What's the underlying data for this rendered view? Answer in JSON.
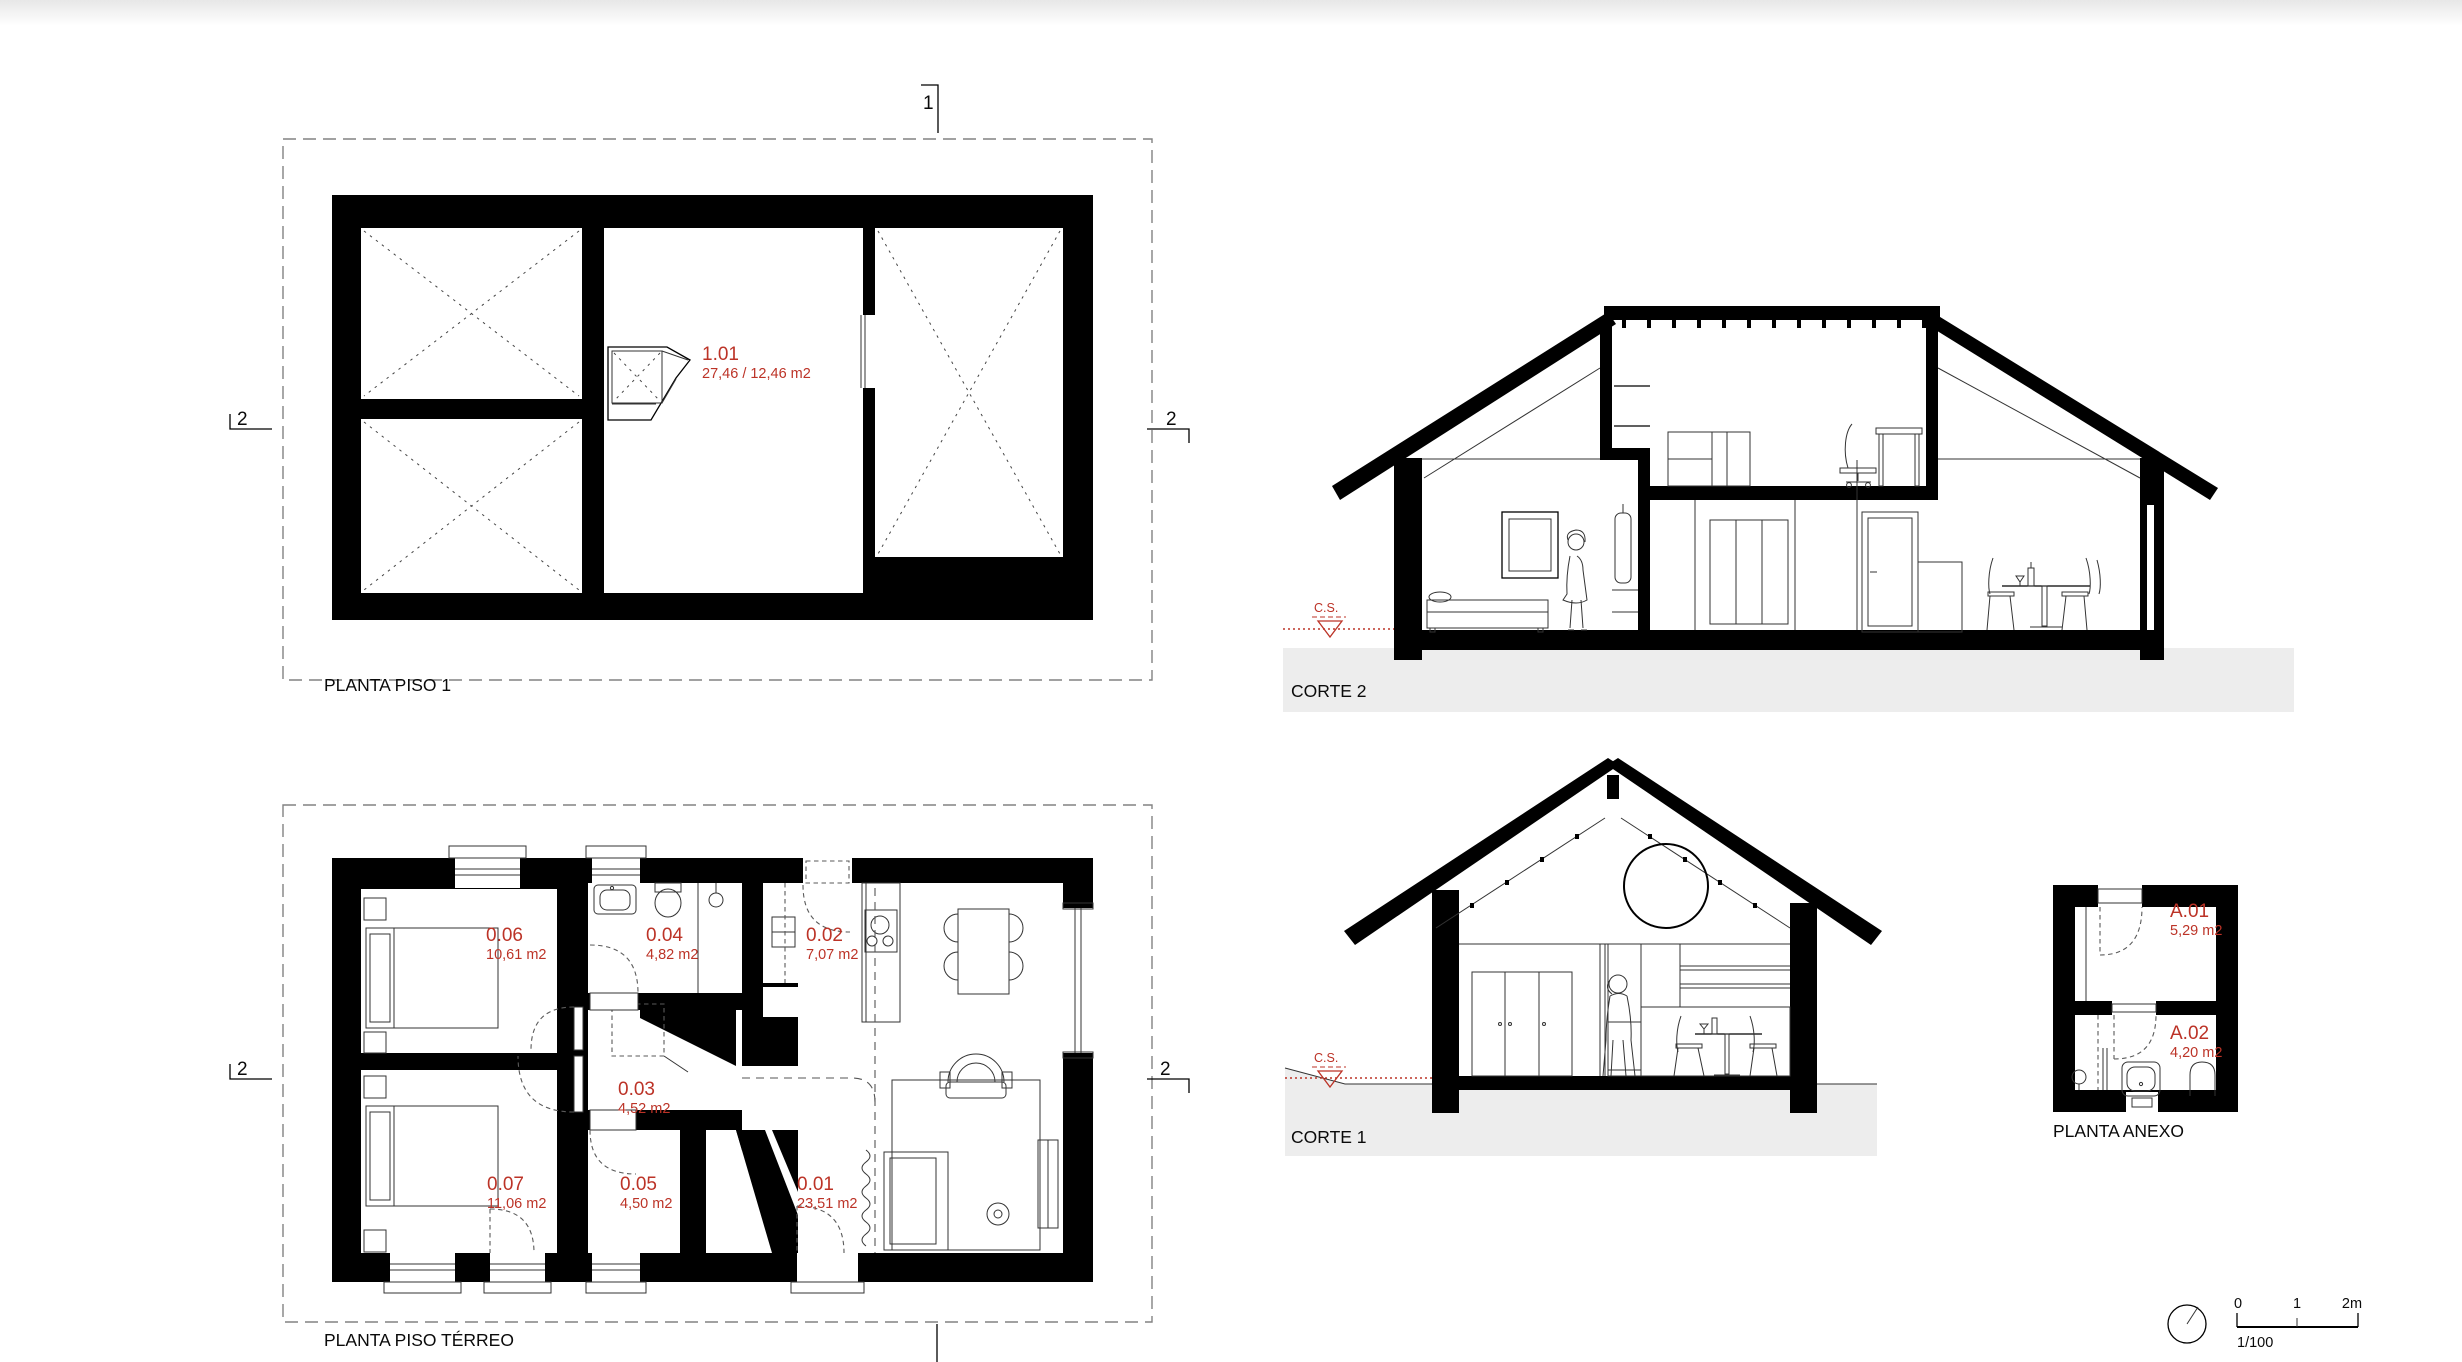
{
  "colors": {
    "accent": "#bc3327",
    "ground": "#ededed"
  },
  "drawings": {
    "planta_piso1": {
      "title": "PLANTA PISO 1",
      "rooms": [
        {
          "id": "1.01",
          "area": "27,46 / 12,46 m2"
        }
      ]
    },
    "corte2": {
      "title": "CORTE 2",
      "level_marker": "C.S."
    },
    "planta_terreo": {
      "title": "PLANTA PISO TÉRREO",
      "rooms": [
        {
          "id": "0.06",
          "area": "10,61 m2"
        },
        {
          "id": "0.04",
          "area": "4,82 m2"
        },
        {
          "id": "0.02",
          "area": "7,07 m2"
        },
        {
          "id": "0.03",
          "area": "4,52 m2"
        },
        {
          "id": "0.07",
          "area": "11,06 m2"
        },
        {
          "id": "0.05",
          "area": "4,50 m2"
        },
        {
          "id": "0.01",
          "area": "23,51 m2"
        }
      ]
    },
    "corte1": {
      "title": "CORTE 1",
      "level_marker": "C.S."
    },
    "planta_anexo": {
      "title": "PLANTA ANEXO",
      "rooms": [
        {
          "id": "A.01",
          "area": "5,29 m2"
        },
        {
          "id": "A.02",
          "area": "4,20 m2"
        }
      ]
    }
  },
  "section_markers": {
    "one": "1",
    "two": "2"
  },
  "scale_bar": {
    "tick0": "0",
    "tick1": "1",
    "tick2": "2m",
    "ratio": "1/100"
  }
}
